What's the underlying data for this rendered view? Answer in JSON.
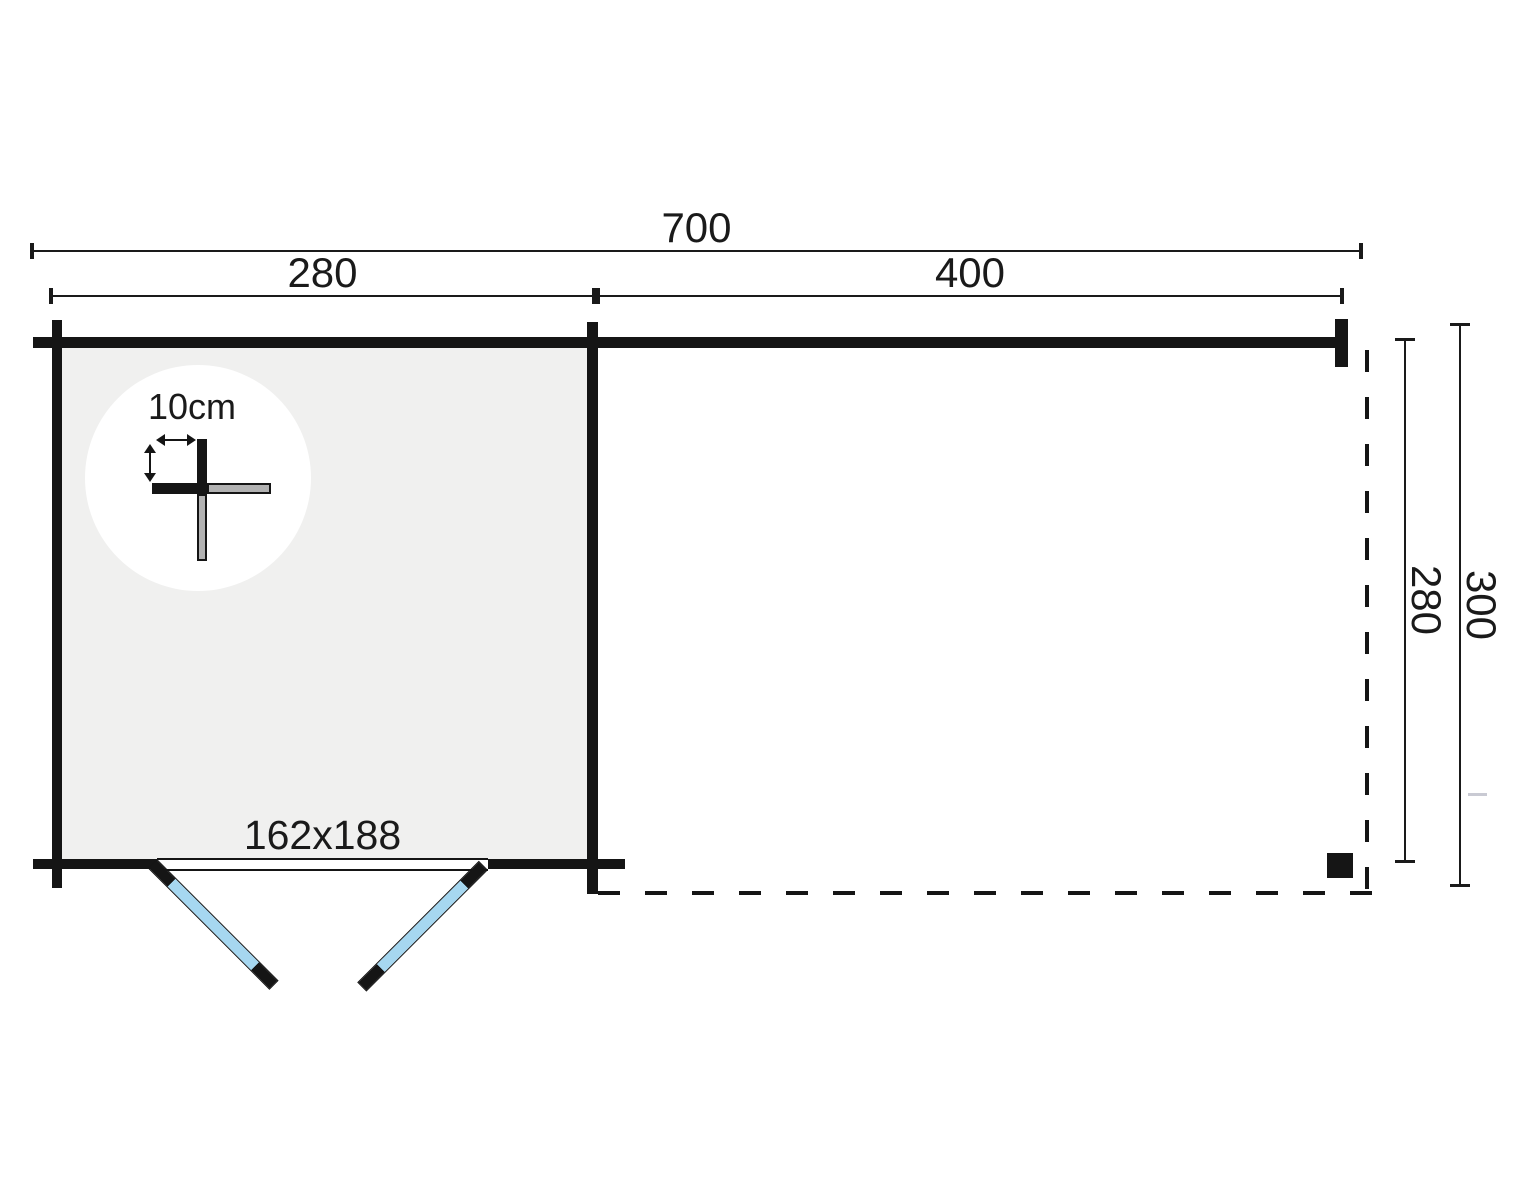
{
  "figure": {
    "labels": {
      "total_width": "700",
      "cabin_width": "280",
      "canopy_width": "400",
      "depth_inner": "280",
      "depth_outer": "300",
      "door_size": "162x188",
      "wall_thickness": "10cm"
    },
    "colors": {
      "wall": "#151515",
      "floor_fill": "#f0f0ef",
      "door_leaf_blue": "#a6d7f0",
      "detail_circle_fill": "#ffffff",
      "log_gray": "#b2b2b2",
      "faint_tick": "#c9cad3",
      "background": "#ffffff"
    }
  }
}
